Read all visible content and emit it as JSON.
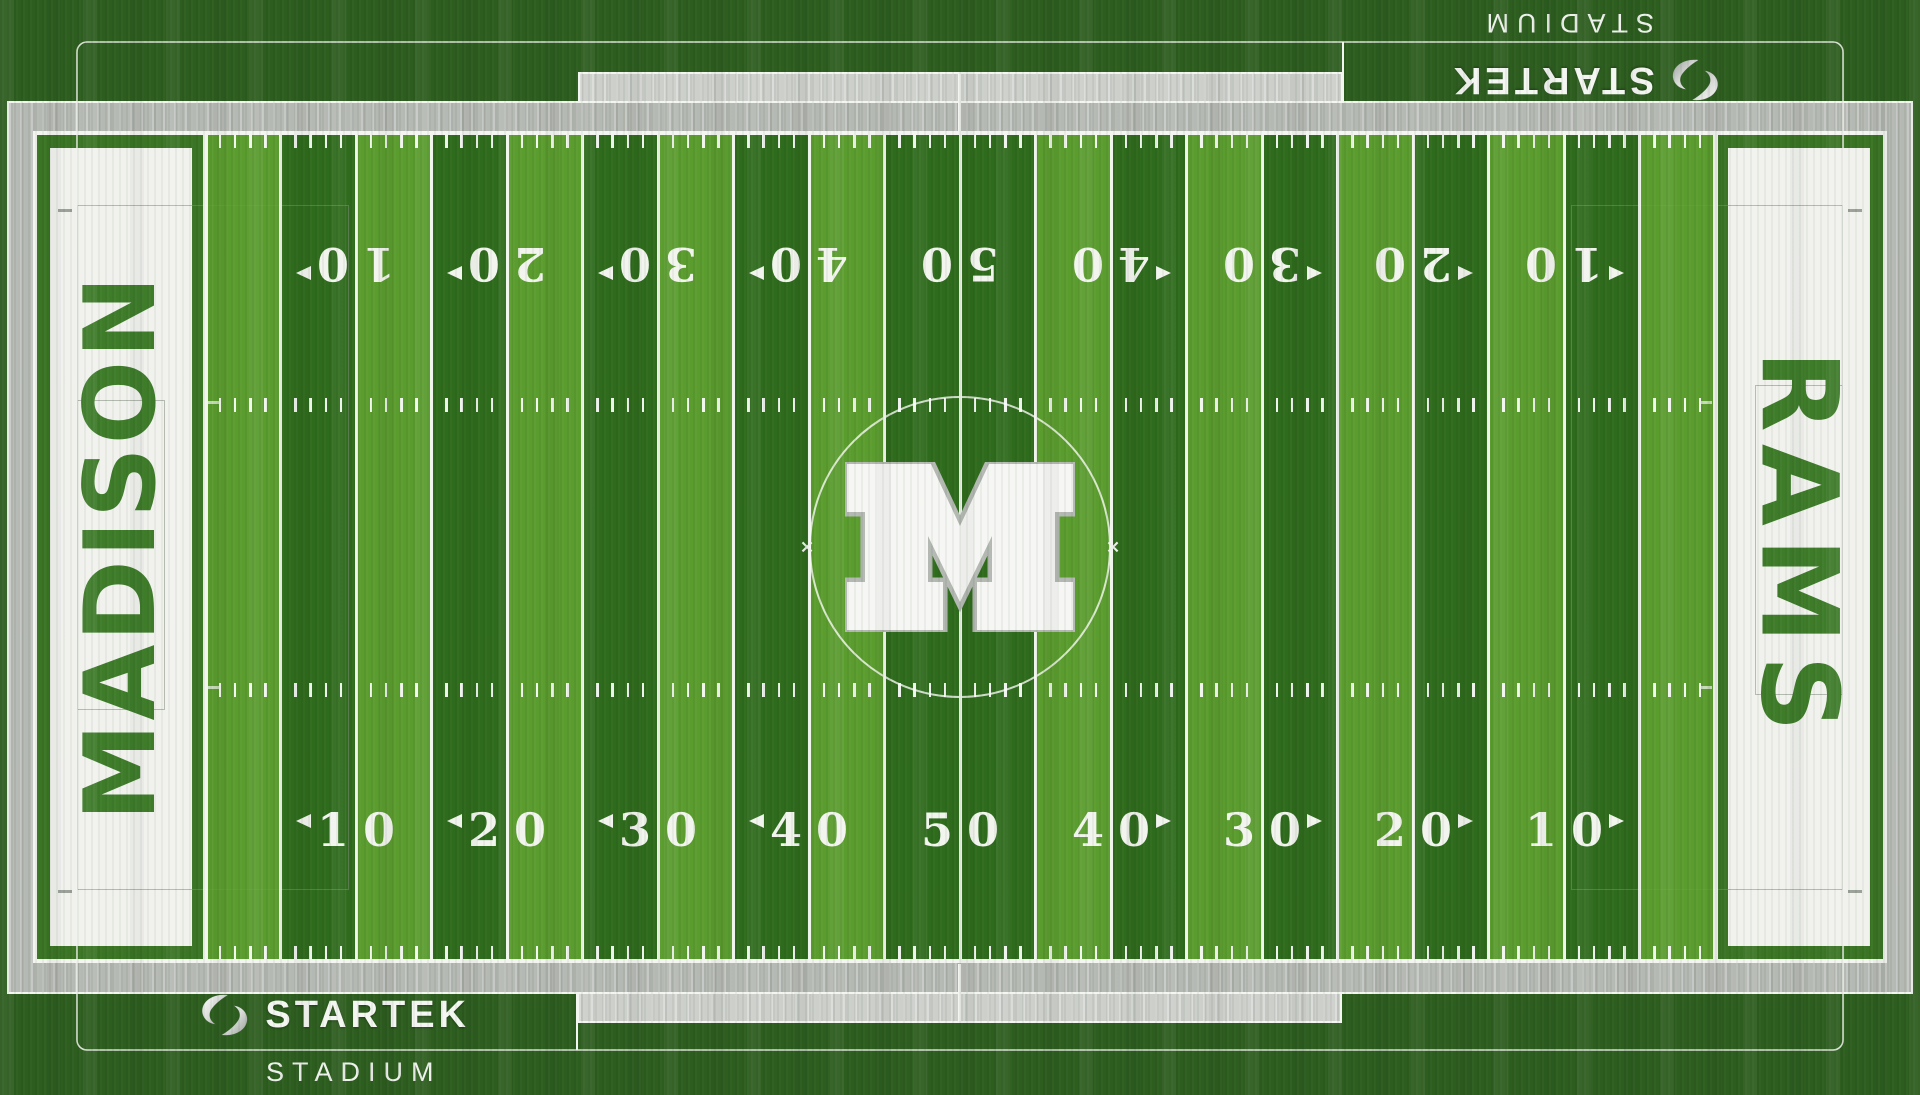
{
  "teams": {
    "home": "MADISON",
    "nickname": "RAMS"
  },
  "branding": {
    "sponsor": "STARTEK",
    "venue": "STADIUM",
    "logo": "startek-swirl-icon"
  },
  "field": {
    "yard_numbers": [
      "10",
      "20",
      "30",
      "40",
      "50",
      "40",
      "30",
      "20",
      "10"
    ],
    "number_arrows": [
      "left",
      "left",
      "left",
      "left",
      "none",
      "right",
      "right",
      "right",
      "right"
    ],
    "center_logo_letter": "M",
    "colors": {
      "outer_green": "#2d5d1f",
      "stripe_light": "#5a9c2e",
      "stripe_dark": "#2e6b1c",
      "endzone_frame": "#3a7424",
      "team_text": "#3e7c2a",
      "ez_white": "#f1f2ee",
      "apron_gray": "#b5b9b3",
      "bench_gray": "#cccfca",
      "line_white": "#f3f5f0",
      "logo_silver": "#c9cdc9"
    }
  }
}
